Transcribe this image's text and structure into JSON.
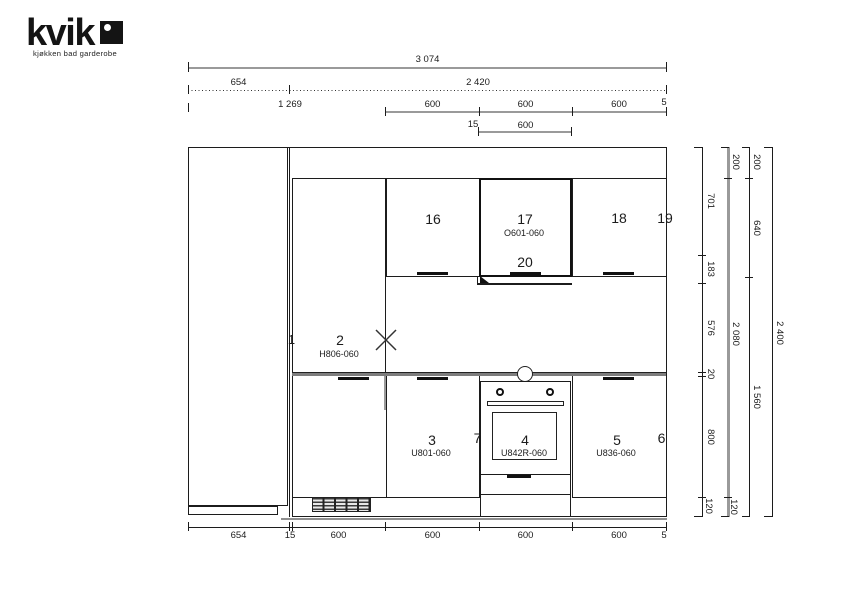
{
  "logo": {
    "brand": "kvik",
    "tagline": "kjøkken bad garderobe",
    "mark": "black-square-with-white-dot"
  },
  "dims": {
    "top": {
      "total": "3 074",
      "row2": [
        "654",
        "2 420"
      ],
      "row3": [
        "1 269",
        "600",
        "600",
        "600",
        "5"
      ],
      "row4": [
        "15",
        "600"
      ]
    },
    "bottom": [
      "654",
      "15",
      "600",
      "600",
      "600",
      "600",
      "5"
    ],
    "right": {
      "col1": [
        "701",
        "183",
        "576",
        "20",
        "800",
        "120"
      ],
      "col2": [
        "200",
        "2 080",
        "120"
      ],
      "col3": [
        "200",
        "640",
        "1 560"
      ],
      "col4": [
        "2 400"
      ]
    }
  },
  "cabinets": {
    "filler_left": "1",
    "tall": {
      "num": "2",
      "code": "H806-060"
    },
    "upper_16": "16",
    "upper_17": {
      "num": "17",
      "code": "O601-060"
    },
    "upper_18": "18",
    "filler_19": "19",
    "hood_20": "20",
    "base_3": {
      "num": "3",
      "code": "U801-060"
    },
    "filler_7": "7",
    "oven_4": {
      "num": "4",
      "code": "U842R-060"
    },
    "base_5": {
      "num": "5",
      "code": "U836-060"
    },
    "filler_6": "6"
  },
  "colors": {
    "line": "#1c1c1c",
    "dim_gray": "#9a9a9a",
    "worktop": "#7d7d7d"
  }
}
